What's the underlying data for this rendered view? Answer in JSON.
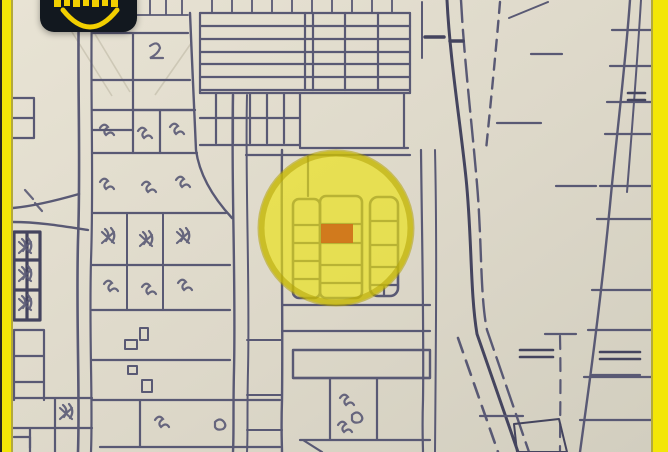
{
  "image": {
    "kind": "photographed hand-drawn cadastral street map (real-estate listing photo)",
    "width_px": 668,
    "height_px": 452,
    "visible_text": "none legible (watermark wordmark cropped at top edge)"
  },
  "colors": {
    "paper": "#e2ddcd",
    "paper-deep": "#d3cfc0",
    "ink": "#595974",
    "ink-heavy": "#44445e",
    "crease": "#c3bdab",
    "frame-yellow": "#f3e607",
    "frame-edge": "#b3a93c",
    "photo-edge": "#272622",
    "highlight-fill": "#ece213",
    "highlight-ring": "#b3a303",
    "plot-orange": "#d0741a",
    "logo-bg": "#12181f",
    "logo-yellow": "#f2cf00",
    "building-fill": "#5d5d7c"
  },
  "logo_badge": {
    "description": "dark rounded-square watermark, top-cropped",
    "elements": [
      "cropped-wordmark-letters",
      "yellow-smile-arc"
    ]
  },
  "map_highlight": {
    "shape": "translucent yellow circle over plot block",
    "marked_plot": "small orange rectangle near circle center"
  }
}
